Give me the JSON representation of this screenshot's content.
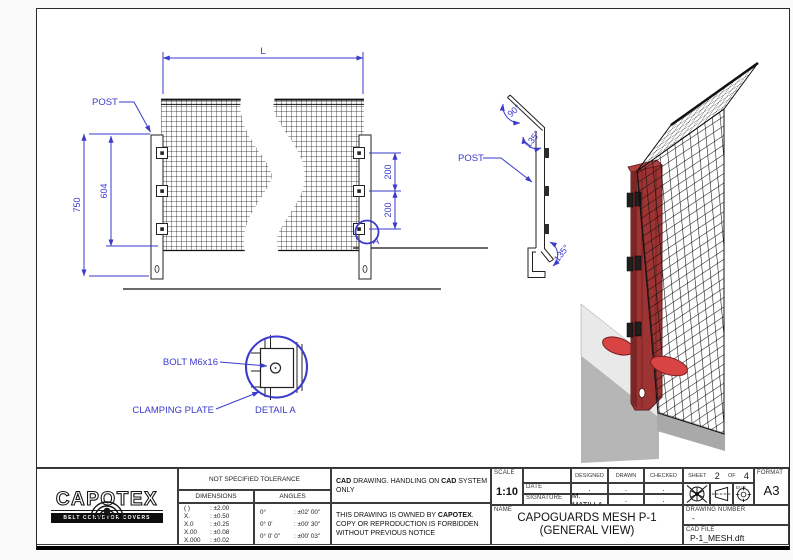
{
  "colors": {
    "dimension_blue": "#3a3acc",
    "post_red": "#9e3333",
    "foot_red": "#d84444",
    "beam_gray": "#b6b6b6"
  },
  "front_view": {
    "length_dim": "L",
    "post_label": "POST",
    "height_dim": "750",
    "inner_height_dim": "604",
    "spacing_dim_1": "200",
    "spacing_dim_2": "200",
    "detail_marker": "A"
  },
  "side_view": {
    "post_label": "POST",
    "angle_top": "90°",
    "angle_mid": "135°",
    "angle_bottom": "135°"
  },
  "detail_a": {
    "bolt_label": "BOLT M6x16",
    "plate_label": "CLAMPING PLATE",
    "title": "DETAIL A"
  },
  "title_block": {
    "logo": {
      "name": "CAPOTEX",
      "tagline": "BELT CONVEYOR COVERS"
    },
    "tolerance": {
      "header": "NOT SPECIFIED TOLERANCE",
      "dimensions_header": "DIMENSIONS",
      "angles_header": "ANGLES",
      "dimensions": [
        {
          "k": "( )",
          "v": ": ±2.00"
        },
        {
          "k": "X.",
          "v": ": ±0.50"
        },
        {
          "k": "X.0",
          "v": ": ±0.25"
        },
        {
          "k": "X.00",
          "v": ": ±0.08"
        },
        {
          "k": "X.000",
          "v": ": ±0.02"
        }
      ],
      "angles": [
        {
          "k": "0°",
          "v": ": ±02' 00\""
        },
        {
          "k": "0° 0'",
          "v": ": ±00' 30\""
        },
        {
          "k": "0° 0' 0\"",
          "v": ": ±00' 03\""
        }
      ]
    },
    "cad_note": {
      "b1": "CAD",
      "t1": " DRAWING. HANDLING ON ",
      "b2": "CAD",
      "t2": " SYSTEM ONLY"
    },
    "ownership": {
      "t1": "THIS DRAWING IS OWNED BY ",
      "b1": "CAPOTEX",
      "t2": ".",
      "l2": "COPY OR REPRODUCTION IS FORBIDDEN",
      "l3": "WITHOUT PREVIOUS NOTICE"
    },
    "info": {
      "scale_label": "SCALE",
      "scale_value": "1:10",
      "date_label": "DATE",
      "signature_label": "SIGNATURE",
      "designed_label": "DESIGNED",
      "drawn_label": "DRAWN",
      "checked_label": "CHECKED",
      "designed_date": ".",
      "drawn_date": ".",
      "checked_date": ".",
      "designed_signature": "M. MATILLA",
      "drawn_signature": ".",
      "checked_signature": ".",
      "sheet_label": "SHEET",
      "sheet_number": "2",
      "of_label": "OF",
      "sheet_total": "4",
      "projection_label": "EUR",
      "format_label": "FORMAT",
      "format_value": "A3",
      "name_label": "NAME",
      "name_line1": "CAPOGUARDS MESH P-1",
      "name_line2": "(GENERAL VIEW)",
      "drawing_number_label": "DRAWING NUMBER",
      "drawing_number_value": "-",
      "cad_file_label": "CAD FILE",
      "cad_file_value": "P-1_MESH.dft"
    }
  }
}
